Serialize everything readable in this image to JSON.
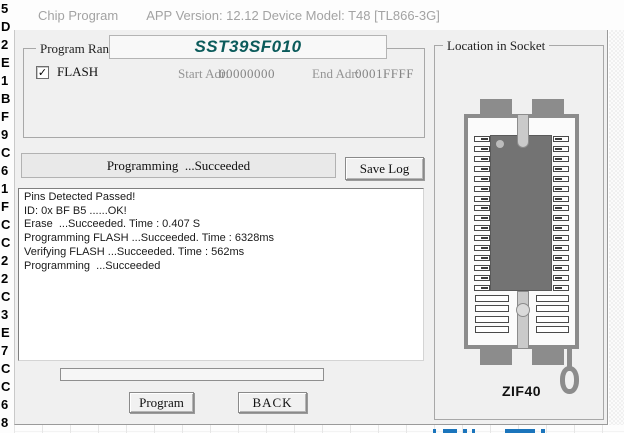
{
  "window": {
    "title": "Chip Program",
    "subtitle": "APP Version: 12.12 Device Model: T48 [TL866-3G]"
  },
  "program_range": {
    "group_label": "Program Range",
    "chip_name": "SST39SF010",
    "flash_label": "FLASH",
    "flash_checked": true,
    "checkmark_glyph": "✓",
    "start_adr_label": "Start Adr:",
    "start_adr_value": "00000000",
    "end_adr_label": "End Adr:",
    "end_adr_value": "0001FFFF"
  },
  "status": {
    "progress_text": "Programming  ...Succeeded",
    "save_log_label": "Save Log"
  },
  "log": {
    "lines": [
      "Pins Detected Passed!",
      "ID: 0x BF B5 ......OK!",
      "Erase  ...Succeeded. Time : 0.407 S",
      "Programming FLASH ...Succeeded. Time : 6328ms",
      "Verifying FLASH ...Succeeded. Time : 562ms",
      "Programming  ...Succeeded"
    ]
  },
  "actions": {
    "program_label": "Program",
    "back_label": "BACK"
  },
  "socket": {
    "group_label": "Location in Socket",
    "socket_name": "ZIF40",
    "pin_rows_per_side": 20,
    "occupied_rows_per_side": 16
  },
  "background_window": {
    "left_edge_hex_chars": [
      "5",
      "D",
      "2",
      "E",
      "1",
      "B",
      "F",
      "9",
      "C",
      "6",
      "1",
      "F",
      "C",
      "C",
      "2",
      "2",
      "C",
      "3",
      "E",
      "7",
      "C",
      "C",
      "6",
      "8"
    ]
  },
  "colors": {
    "chip_name_teal": "#0b5b5b",
    "socket_gray": "#8c8c8c",
    "partial_text_blue": "#1b75bc",
    "dialog_bg": "#f0f0f0"
  }
}
